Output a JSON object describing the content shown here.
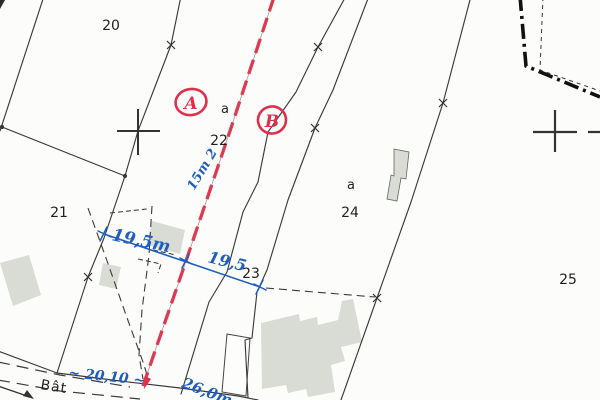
{
  "parcels": [
    {
      "number": "20"
    },
    {
      "number": "21"
    },
    {
      "number": "22"
    },
    {
      "number": "23"
    },
    {
      "number": "24"
    },
    {
      "number": "25"
    }
  ],
  "sub_parcel_labels": [
    {
      "text": "a"
    },
    {
      "text": "a"
    }
  ],
  "boundary_points": [
    {
      "label": "A"
    },
    {
      "label": "B"
    }
  ],
  "road_label": "Bât",
  "measurements": [
    {
      "text": "19,5m"
    },
    {
      "text": "19,5"
    },
    {
      "text": "15m 2"
    },
    {
      "text": "~ 20,10 ~"
    },
    {
      "text": "26,0m"
    }
  ],
  "colors": {
    "paper": "#fcfcfa",
    "ink": "#3a3a3a",
    "proposed_boundary_red": "#de3049",
    "annotation_blue": "#1e5ec0",
    "building_fill": "#d9dbd5"
  }
}
